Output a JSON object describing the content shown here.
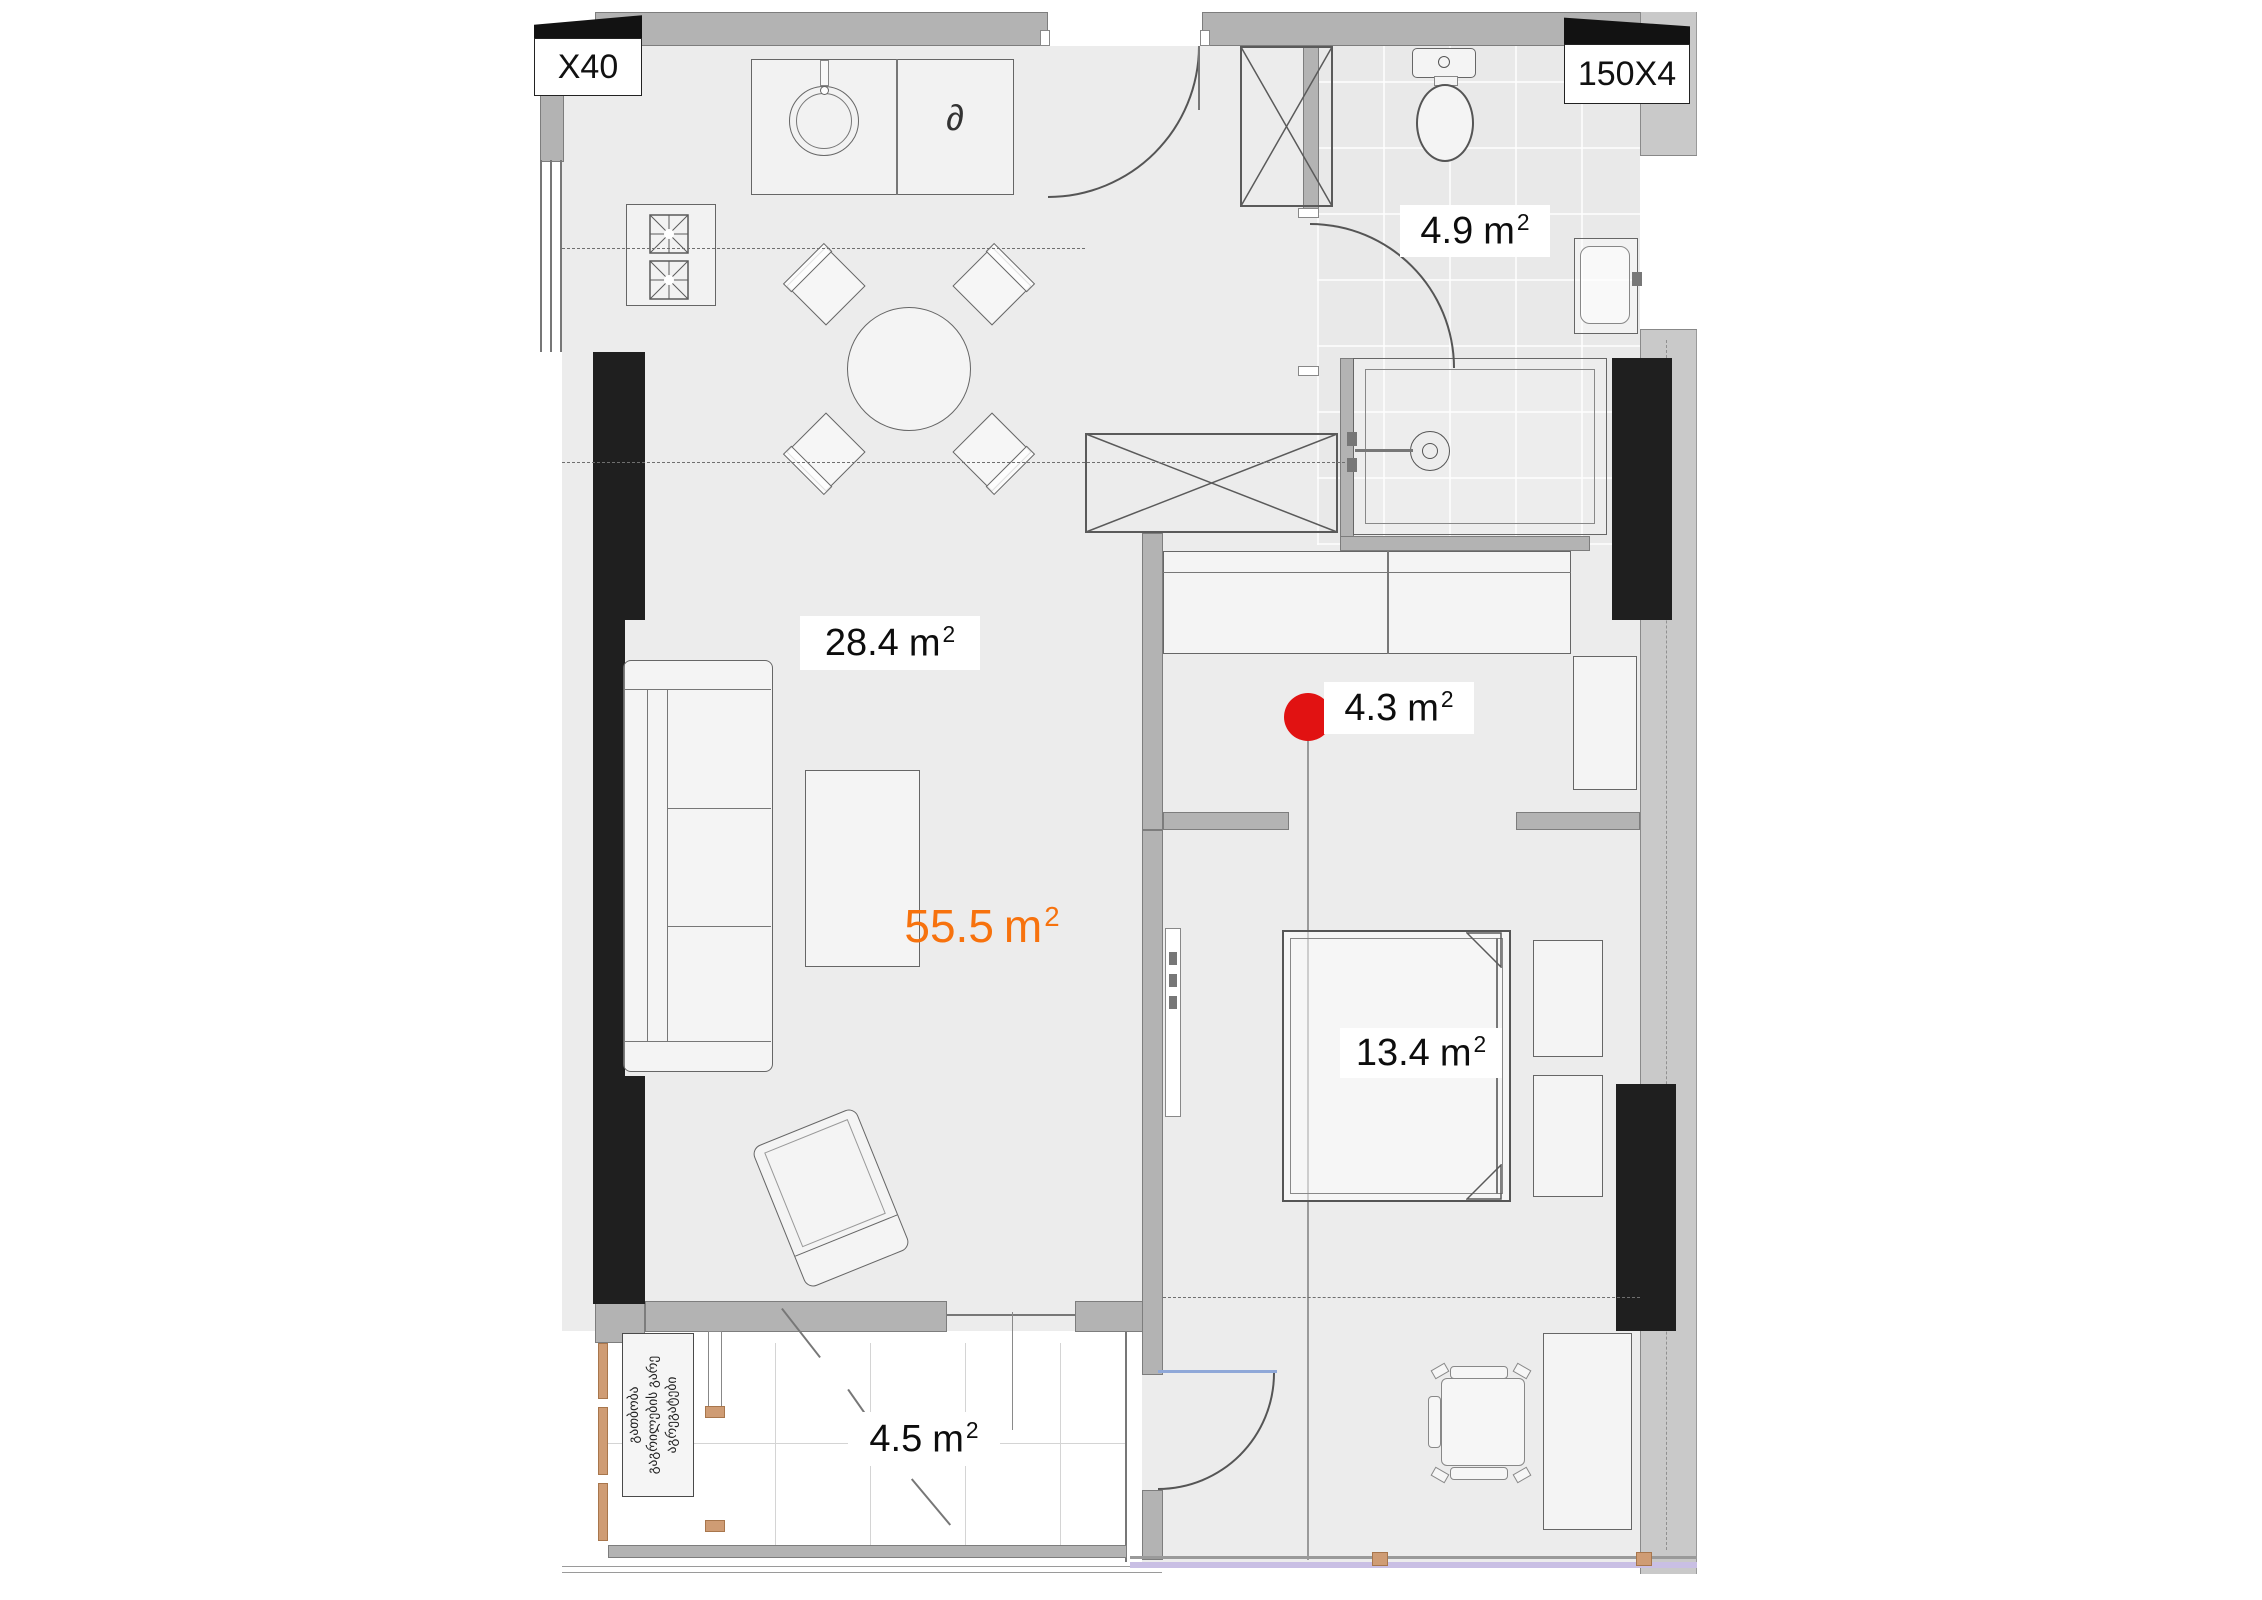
{
  "title": "apartment-floor-plan",
  "unit": {
    "symbol": "m",
    "sup": "2"
  },
  "rooms": {
    "living": {
      "area": "28.4"
    },
    "bathroom": {
      "area": "4.9"
    },
    "hall": {
      "area": "4.3"
    },
    "bedroom": {
      "area": "13.4"
    },
    "balcony": {
      "area": "4.5"
    }
  },
  "total": {
    "area": "55.5"
  },
  "window_labels": {
    "left": "X40",
    "right": "150X4"
  },
  "appliance_symbol": "∂",
  "note": {
    "line1": "გათბობა",
    "line2": "გაგრილების გარე",
    "line3": "აგრეგატები"
  },
  "colors": {
    "total_accent": "#f7720d",
    "marker_red": "#e11212",
    "walls_gray": "#b3b3b3",
    "black_walls": "#1f1f1f",
    "wood": "#cf9c74",
    "door_glass": "#8fa8d8",
    "window_sill": "#c9bfe4"
  },
  "styles": {
    "marker": "background:#e11212;border-radius:50%;width:100%;height:100%;display:block",
    "total": "color:#f7720d",
    "glass": "background:#8fa8d8;width:100%;height:100%;display:block",
    "sill": "background:#c9bfe4;width:100%;height:100%;display:block",
    "wood": "background:#cf9c74;border:1px solid #a8764c;width:100%;height:100%;display:block;box-sizing:border-box"
  }
}
